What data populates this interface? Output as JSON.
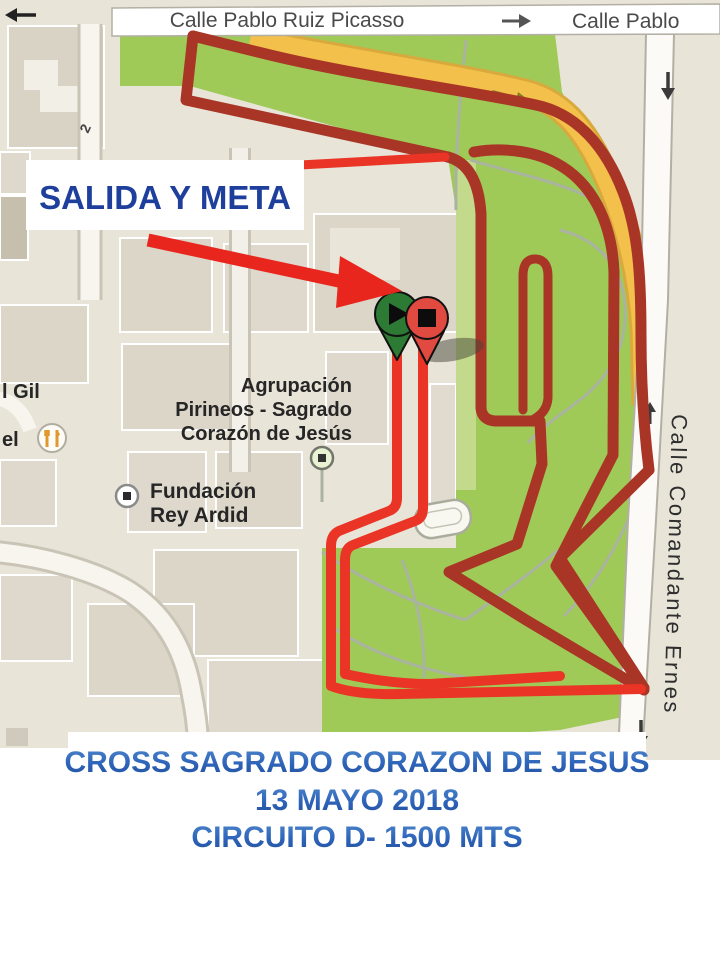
{
  "streets": {
    "top": "Calle Pablo Ruiz Picasso",
    "top_right": "Calle Pablo",
    "right_vertical": "Calle Comandante Ernes",
    "block_number": "2"
  },
  "callout": {
    "label": "SALIDA Y META"
  },
  "poi": {
    "agrupacion_line1": "Agrupación",
    "agrupacion_line2": "Pirineos - Sagrado",
    "agrupacion_line3": "Corazón de Jesús",
    "fundacion_line1": "Fundación",
    "fundacion_line2": "Rey Ardid",
    "left_edge_label_1": "l Gil",
    "left_edge_label_2": "el"
  },
  "title_box": {
    "line1": "CROSS SAGRADO CORAZON DE JESUS",
    "line2": "13 MAYO 2018",
    "line3": "CIRCUITO D- 1500 MTS"
  },
  "markers": {
    "start": "green pin with play symbol (salida)",
    "finish": "red pin with stop symbol (meta)"
  },
  "colors": {
    "route_dark": "#a93526",
    "route_bright": "#ea3425",
    "park_green": "#9fca57",
    "park_green_light": "#c3d98b",
    "road_yellow": "#f3c04b",
    "base_beige": "#e8e4d8",
    "building": "#dbd6c8",
    "title_blue": "#2d63b9",
    "callout_blue": "#1e3f9c",
    "arrow_red": "#e8261d"
  }
}
